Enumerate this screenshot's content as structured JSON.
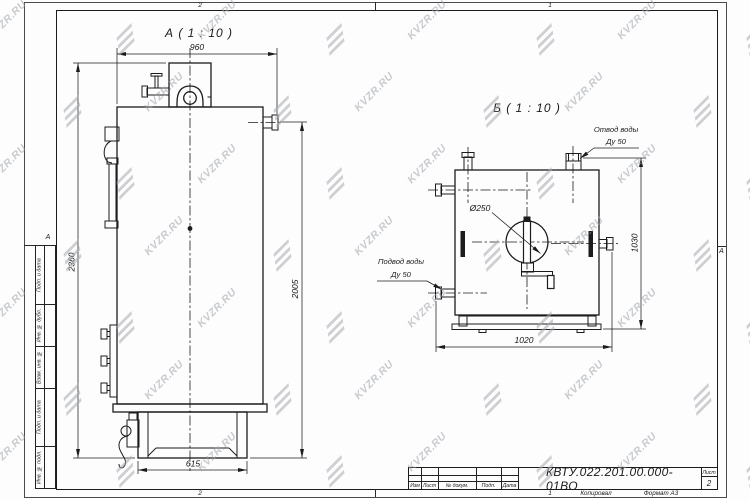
{
  "watermark": {
    "text": "KVZR.RU"
  },
  "frame": {
    "zones": {
      "top_left": "2",
      "top_right": "1",
      "bottom_left": "2",
      "bottom_right": "1",
      "row_letter_left": "А",
      "row_letter_right": "А"
    },
    "sidebar": [
      "Подп. и дата",
      "Инв. № дубл.",
      "Взам. инв. №",
      "Подп. и дата",
      "Инв. № подл."
    ]
  },
  "views": {
    "a": {
      "title": "А ( 1 : 10 )",
      "dims": {
        "width_top": "960",
        "height_left": "2360",
        "height_right": "2005",
        "base_width": "615"
      }
    },
    "b": {
      "title": "Б ( 1 : 10 )",
      "dims": {
        "width_bottom": "1020",
        "height_right": "1030",
        "diameter": "Ø250"
      },
      "labels": {
        "outlet_line1": "Отвод воды",
        "outlet_line2": "Ду 50",
        "inlet_line1": "Подвод воды",
        "inlet_line2": "Ду 50"
      }
    }
  },
  "title_block": {
    "designation": "КВТУ.022.201.00.000-01ВО",
    "columns": [
      "Изм",
      "Лист",
      "№ докум.",
      "Подп.",
      "Дата"
    ],
    "sheet_label": "Лист",
    "sheet_number": "2",
    "footer_copied": "Копировал",
    "footer_format": "Формат А3"
  }
}
